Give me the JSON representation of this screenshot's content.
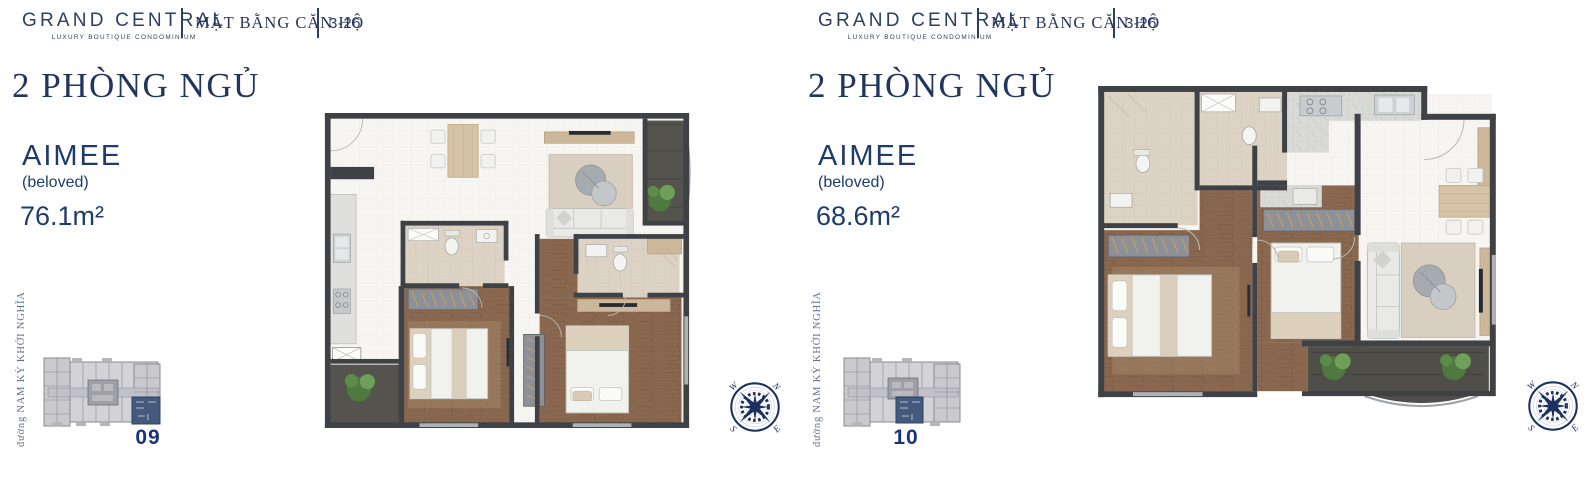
{
  "header": {
    "brand_name": "GRAND CENTRAL",
    "brand_tagline": "LUXURY BOUTIQUE CONDOMINIUM",
    "section_title": "MẶT BẰNG CĂN HỘ",
    "floor_range": "3-26"
  },
  "compass": {
    "west": "W",
    "north": "N",
    "south": "S",
    "east": "E"
  },
  "panels": [
    {
      "bedroom_type": "2 PHÒNG NGỦ",
      "unit_name": "AIMEE",
      "unit_nickname": "(beloved)",
      "unit_area": "76.1m²",
      "street_name": "đường NAM KỲ KHỞI NGHĨA",
      "unit_number": "09"
    },
    {
      "bedroom_type": "2 PHÒNG NGỦ",
      "unit_name": "AIMEE",
      "unit_nickname": "(beloved)",
      "unit_area": "68.6m²",
      "street_name": "đường NAM KỲ KHỞI NGHĨA",
      "unit_number": "10"
    }
  ],
  "colors": {
    "navy": "#22355f",
    "text_blue": "#1e3b6b",
    "street_blue": "#5d6f9e",
    "wall": "#3e4247",
    "wood_floor": "#8a6850",
    "bath_tile": "#ddd3c5",
    "balcony_floor": "#54534d",
    "highlighted_unit": "#44597c"
  }
}
